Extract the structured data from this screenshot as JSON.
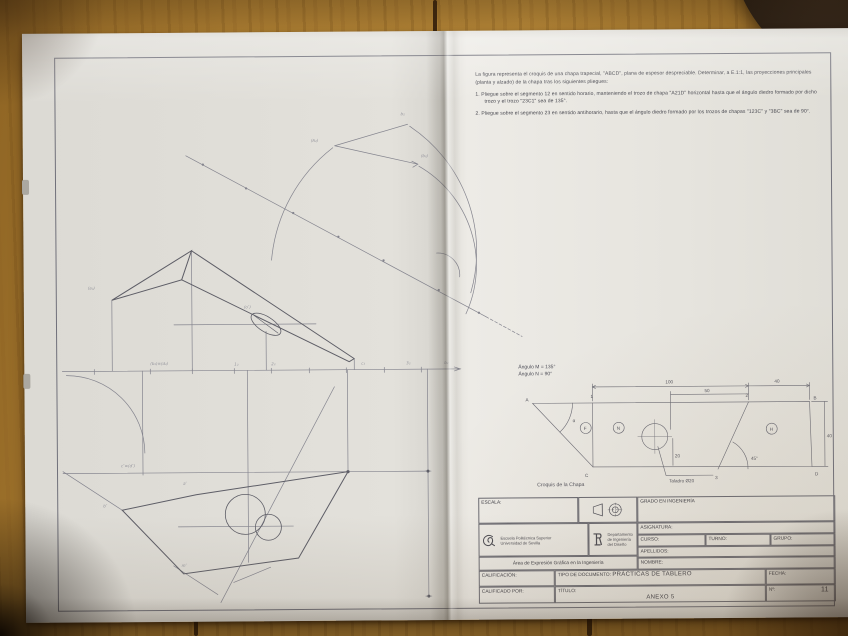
{
  "colors": {
    "wood": "#a5782e",
    "paper": "#e3e1db",
    "pencil": "#84848e",
    "ink": "#55555e",
    "dark_object": "#241a10"
  },
  "instructions": {
    "intro": "La figura representa el croquis de una chapa trapecial, \"ABCD\", plana de espesor despreciable. Determinar, a E.1:1, las proyecciones principales (planta y alzado) de la chapa tras los siguientes pliegues:",
    "items": [
      "1.  Pliegue sobre el segmento 12 en sentido horario, manteniendo el trozo de chapa \"A21D\" horizontal hasta que el ángulo diedro formado por dicho trozo y el trozo \"23C1\" sea de 135°.",
      "2.  Pliegue sobre el segmento 23 en sentido antihorario, hasta que el ángulo diedro formado por los trozos de chapas \"123C\" y \"3BC\" sea de 90°."
    ]
  },
  "croquis": {
    "angle_note_1": "Ángulo M = 135°",
    "angle_note_2": "Ángulo N = 90°",
    "caption": "Croquis de la Chapa",
    "hole_label": "Taladro Ø20",
    "dim_top": "100",
    "dim_top_right": "40",
    "dim_mid": "50",
    "dim_right": "40",
    "dim_hole": "20",
    "v_a": "A",
    "v_1": "1",
    "v_2": "2",
    "v_b": "B",
    "v_c": "C",
    "v_3": "3",
    "v_d": "D",
    "r_1": "F",
    "r_2": "N",
    "r_3": "H",
    "ang_a": "α",
    "ang_3": "45°"
  },
  "titleblock": {
    "escala": "ESCALA:",
    "grado": "GRADO EN INGENIERÍA",
    "asignatura": "ASIGNATURA:",
    "curso": "CURSO:",
    "turno": "TURNO:",
    "grupo": "GRUPO:",
    "apellidos": "APELLIDOS:",
    "nombre": "NOMBRE:",
    "eps_line1": "Escuela Politécnica Superior",
    "eps_line2": "Universidad de Sevilla",
    "dept_line1": "Departamento",
    "dept_line2": "de Ingeniería",
    "dept_line3": "del Diseño",
    "area": "Área de Expresión Gráfica en la Ingeniería",
    "calificacion": "CALIFICACIÓN:",
    "calificado": "CALIFICADO POR:",
    "tipo_label": "TIPO DE DOCUMENTO:",
    "tipo_value": "PRÁCTICAS DE TABLERO",
    "fecha": "FECHA:",
    "titulo_label": "TÍTULO:",
    "titulo_value": "ANEXO 5",
    "num_label": "Nº:",
    "num_value": "11"
  },
  "drawing": {
    "labels": [
      "(b₂)≡(d₂)",
      "1₂",
      "2₂",
      "c₂",
      "3₂",
      "b₂",
      "(A₂)",
      "(b₂)",
      "b₂",
      "(a₂)",
      "c″≡(d″)",
      "a″",
      "b″",
      "m″",
      "(o″)"
    ]
  }
}
